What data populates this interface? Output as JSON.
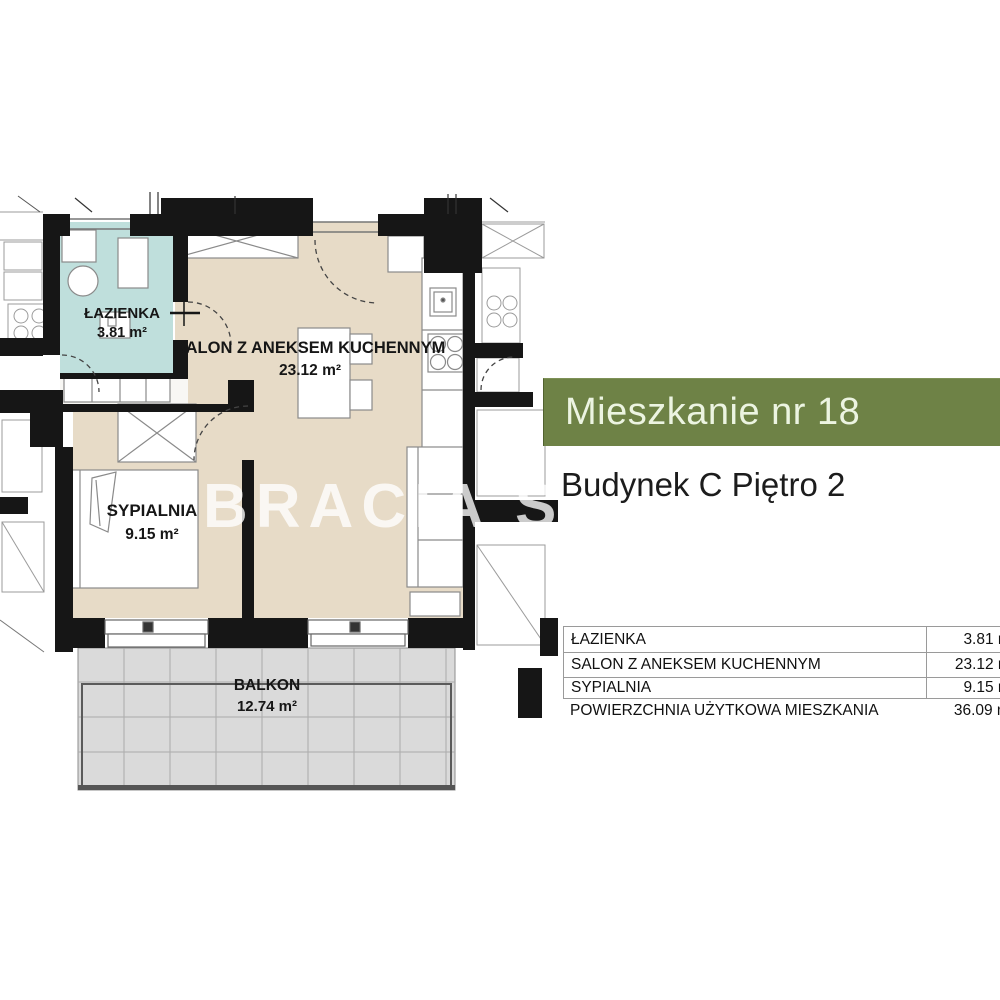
{
  "header": {
    "title": "Mieszkanie nr 18",
    "subtitle": "Budynek C Piętro 2",
    "bar_color": "#6e8246",
    "title_color": "#ecf4e1",
    "subtitle_color": "#1c1c1c"
  },
  "watermark": {
    "text": "BRACIA SA"
  },
  "plan": {
    "wall_color": "#161616",
    "rooms": [
      {
        "name": "ŁAZIENKA",
        "area": "3.81 m²",
        "fill": "#bfdfdc"
      },
      {
        "name": "SALON Z ANEKSEM KUCHENNYM",
        "area": "23.12 m²",
        "fill": "#e7dbc7"
      },
      {
        "name": "SYPIALNIA",
        "area": "9.15 m²",
        "fill": "#e7dbc7"
      },
      {
        "name": "BALKON",
        "area": "12.74 m²",
        "fill": "#dadada"
      }
    ]
  },
  "table": {
    "rows": [
      {
        "label": "ŁAZIENKA",
        "value": "3.81 m²"
      },
      {
        "label": "SALON Z ANEKSEM KUCHENNYM",
        "value": "23.12 m²"
      },
      {
        "label": "SYPIALNIA",
        "value": "9.15 m²"
      },
      {
        "label": "POWIERZCHNIA UŻYTKOWA MIESZKANIA",
        "value": "36.09 m²"
      }
    ]
  }
}
